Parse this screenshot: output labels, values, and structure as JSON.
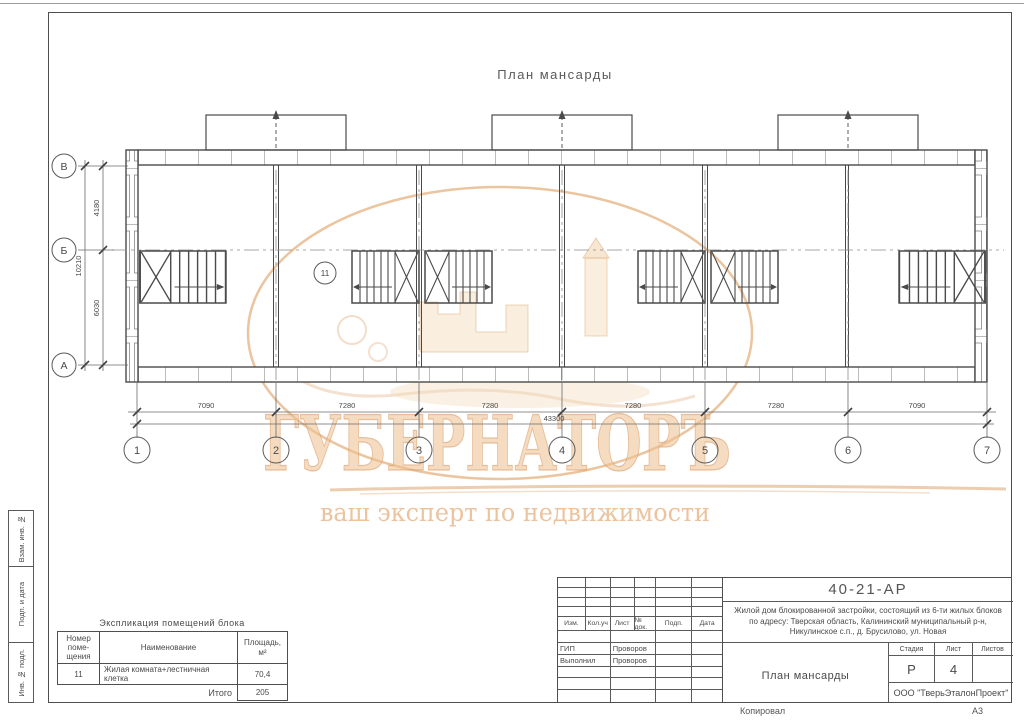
{
  "sheet": {
    "top_title": "План мансарды",
    "copied_label": "Копировал",
    "format_label": "А3"
  },
  "watermark": {
    "brand": "ГУБЕРНАТОРЪ",
    "tagline": "ваш эксперт по недвижимости",
    "accent_color": "#e8bb8e"
  },
  "plan": {
    "axes_bottom": [
      "1",
      "2",
      "3",
      "4",
      "5",
      "6",
      "7"
    ],
    "axes_left": [
      "В",
      "Б",
      "А"
    ],
    "dims_bottom": [
      "7090",
      "7280",
      "7280",
      "7280",
      "7280",
      "7090"
    ],
    "dim_total_bottom": "43300",
    "dims_left": [
      "4180",
      "6030"
    ],
    "dim_total_left": "10210",
    "room_label": "11"
  },
  "explication": {
    "title": "Экспликация помещений блока",
    "col_number": "Номер\nпоме-\nщения",
    "col_name": "Наименование",
    "col_area": "Площадь,\nм²",
    "row_number": "11",
    "row_name": "Жилая комната+лестничная клетка",
    "row_area": "70,4",
    "total_label": "Итого",
    "total_value": "205"
  },
  "titleblock": {
    "doc_number": "40-21-АР",
    "desc1": "Жилой дом блокированной застройки, состоящий из 6-ти жилых блоков",
    "desc2": "по адресу: Тверская область, Калининский муниципальный р-н,",
    "desc3": "Никулинское с.п., д. Брусилово, ул. Новая",
    "col1": "Изм.",
    "col2": "Кол.уч",
    "col3": "Лист",
    "col4": "№ док.",
    "col5": "Подп.",
    "col6": "Дата",
    "role1": "ГИП",
    "name1": "Проворов",
    "role2": "Выполнил",
    "name2": "Проворов",
    "stage_label": "Стадия",
    "sheet_label": "Лист",
    "sheets_label": "Листов",
    "stage_value": "Р",
    "sheet_value": "4",
    "sheets_value": "",
    "drawing_name": "План мансарды",
    "company": "ООО \"ТверьЭталонПроект\""
  },
  "side_stamp": {
    "box1": "Взам. инв. №",
    "box2": "Подп. и дата",
    "box3": "Инв. № подл."
  }
}
